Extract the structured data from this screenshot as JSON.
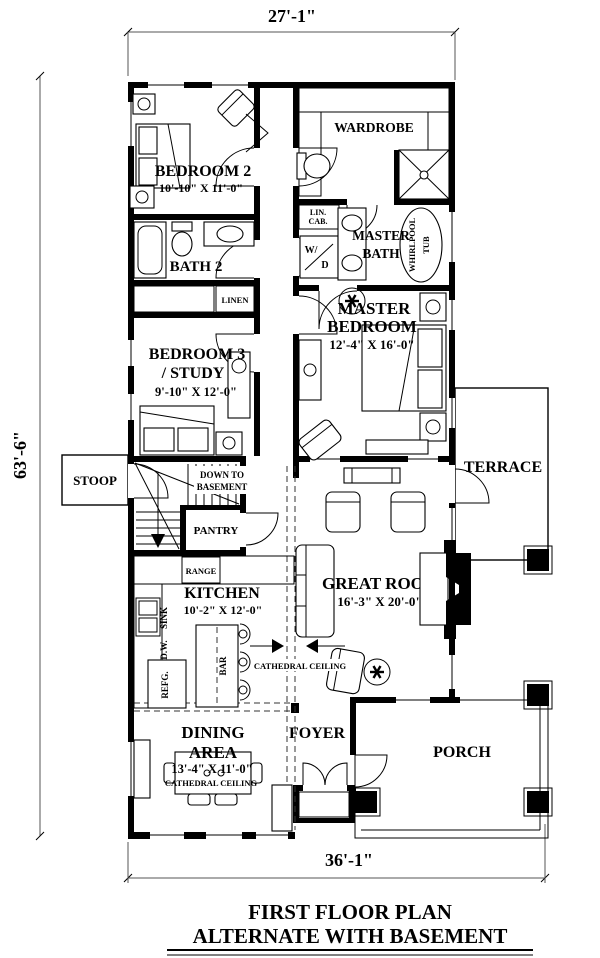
{
  "colors": {
    "wall": "#000000",
    "paper": "#ffffff",
    "line": "#555555"
  },
  "dimensions": {
    "top": "27'-1\"",
    "left": "63'-6\"",
    "bottom": "36'-1\""
  },
  "title": {
    "line1": "FIRST FLOOR PLAN",
    "line2": "ALTERNATE WITH BASEMENT"
  },
  "rooms": {
    "bedroom2": {
      "name": "BEDROOM 2",
      "size": "10'-10\" X 11'-0\""
    },
    "wardrobe": {
      "name": "WARDROBE"
    },
    "lin_cab": {
      "line1": "LIN.",
      "line2": "CAB."
    },
    "master_bath": {
      "line1": "MASTER",
      "line2": "BATH"
    },
    "whirlpool": {
      "line1": "WHIRLPOOL",
      "line2": "TUB"
    },
    "wd": {
      "line1": "W/",
      "line2": "D"
    },
    "bath2": {
      "name": "BATH 2"
    },
    "linen": {
      "name": "LINEN"
    },
    "bedroom3": {
      "line1": "BEDROOM 3",
      "line2": "/ STUDY",
      "size": "9'-10\" X 12'-0\""
    },
    "master_bedroom": {
      "line1": "MASTER",
      "line2": "BEDROOM",
      "size": "12'-4\" X 16'-0\""
    },
    "stoop": {
      "name": "STOOP"
    },
    "stairs": {
      "line1": "DOWN TO",
      "line2": "BASEMENT"
    },
    "pantry": {
      "name": "PANTRY"
    },
    "terrace": {
      "name": "TERRACE"
    },
    "kitchen": {
      "name": "KITCHEN",
      "size": "10'-2\" X 12'-0\"",
      "range": "RANGE",
      "sink": "SINK",
      "dw": "D.W.",
      "refg": "REFG.",
      "bar": "BAR"
    },
    "great_room": {
      "name": "GREAT ROOM",
      "size": "16'-3\" X 20'-0\"",
      "ceiling": "CATHEDRAL CEILING"
    },
    "dining": {
      "line1": "DINING",
      "line2": "AREA",
      "size": "13'-4\" X 11'-0\"",
      "ceiling": "CATHEDRAL CEILING"
    },
    "foyer": {
      "name": "FOYER"
    },
    "porch": {
      "name": "PORCH"
    }
  }
}
